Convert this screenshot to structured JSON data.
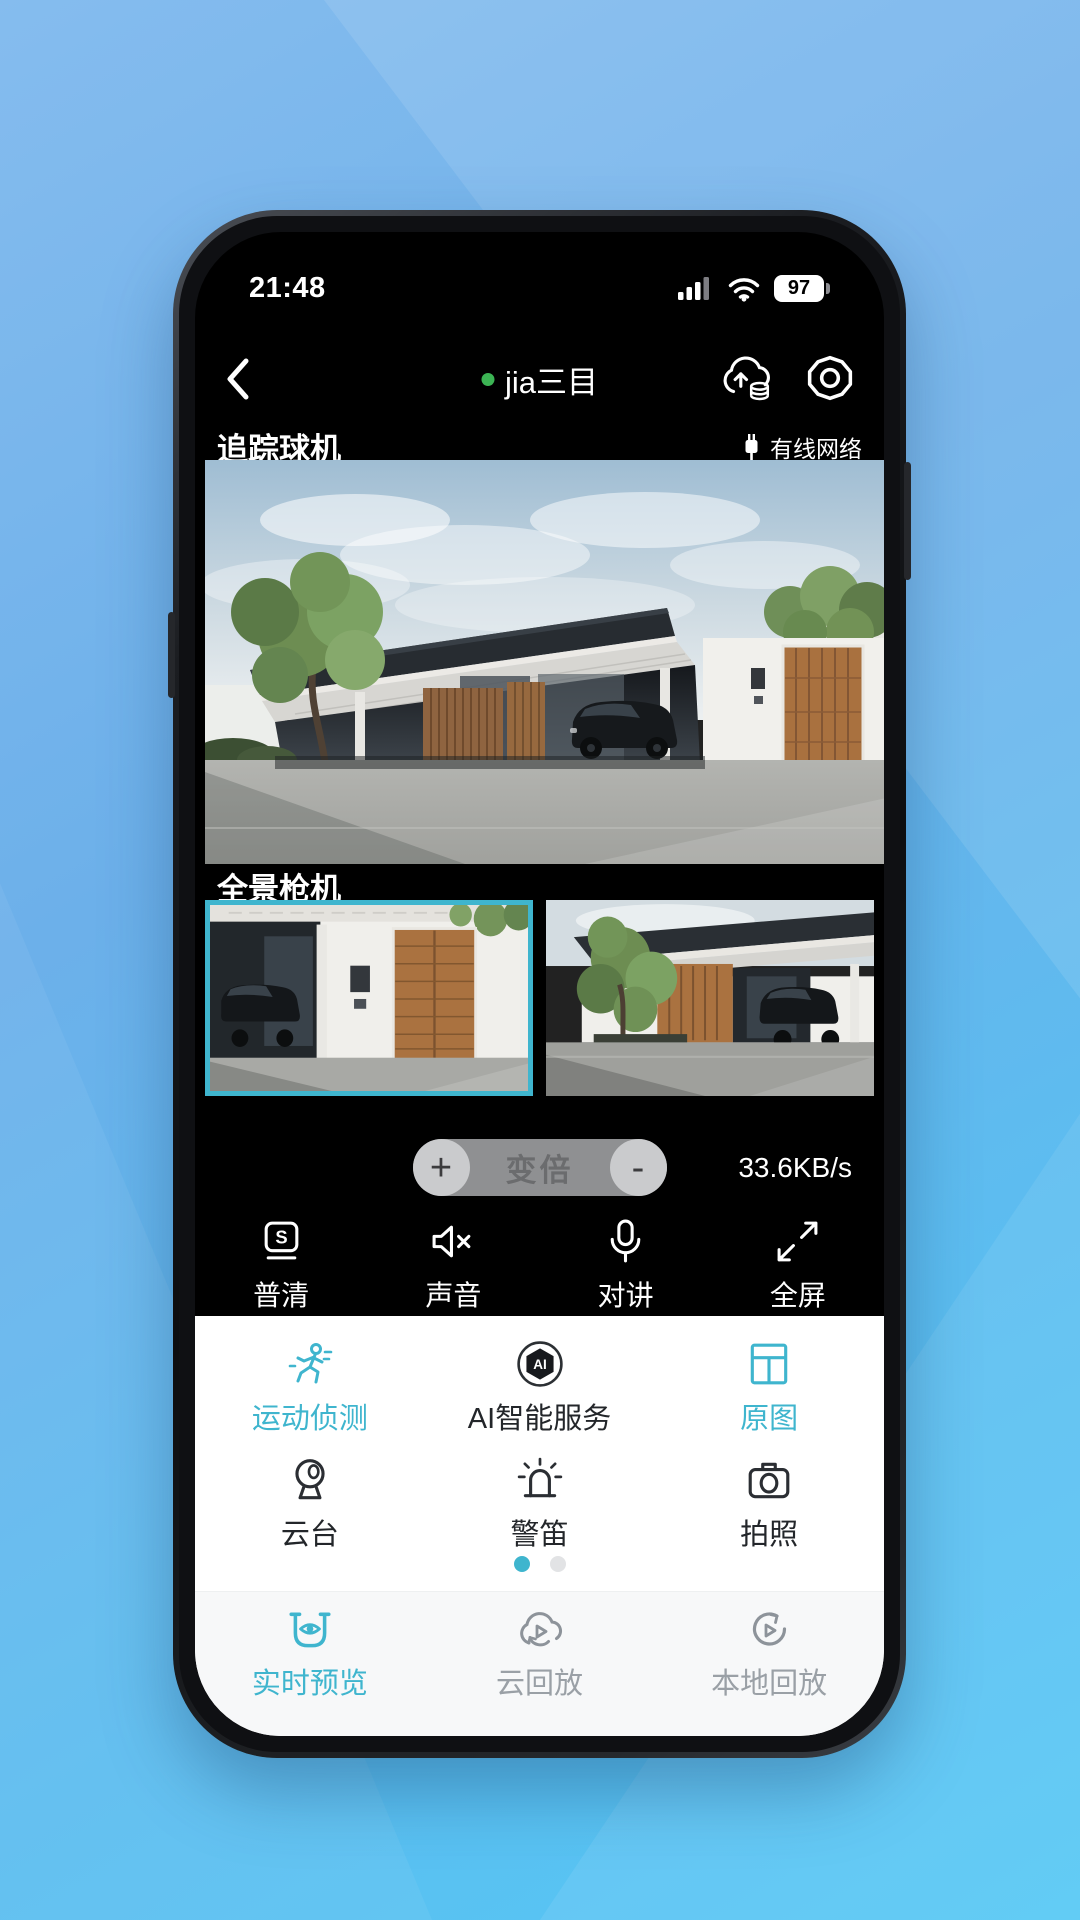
{
  "colors": {
    "accent": "#3FB5CE",
    "online_green": "#3CB454",
    "panel_text": "#23262A",
    "nav_inactive": "#9AA0A6"
  },
  "status_bar": {
    "time": "21:48",
    "battery_percent": "97"
  },
  "header": {
    "title": "jia三目"
  },
  "tracking_camera": {
    "label": "追踪球机",
    "network_label": "有线网络"
  },
  "panorama_camera": {
    "label": "全景枪机"
  },
  "zoom_control": {
    "plus": "+",
    "label": "变倍",
    "minus": "-",
    "bitrate": "33.6KB/s"
  },
  "toolbar": {
    "items": [
      {
        "label": "普清",
        "badge": "S"
      },
      {
        "label": "声音"
      },
      {
        "label": "对讲"
      },
      {
        "label": "全屏"
      }
    ]
  },
  "feature_panel": {
    "rows": [
      [
        {
          "label": "运动侦测"
        },
        {
          "label": "AI智能服务",
          "badge": "AI"
        },
        {
          "label": "原图"
        }
      ],
      [
        {
          "label": "云台"
        },
        {
          "label": "警笛"
        },
        {
          "label": "拍照"
        }
      ]
    ]
  },
  "bottom_nav": {
    "items": [
      {
        "label": "实时预览"
      },
      {
        "label": "云回放"
      },
      {
        "label": "本地回放"
      }
    ]
  }
}
